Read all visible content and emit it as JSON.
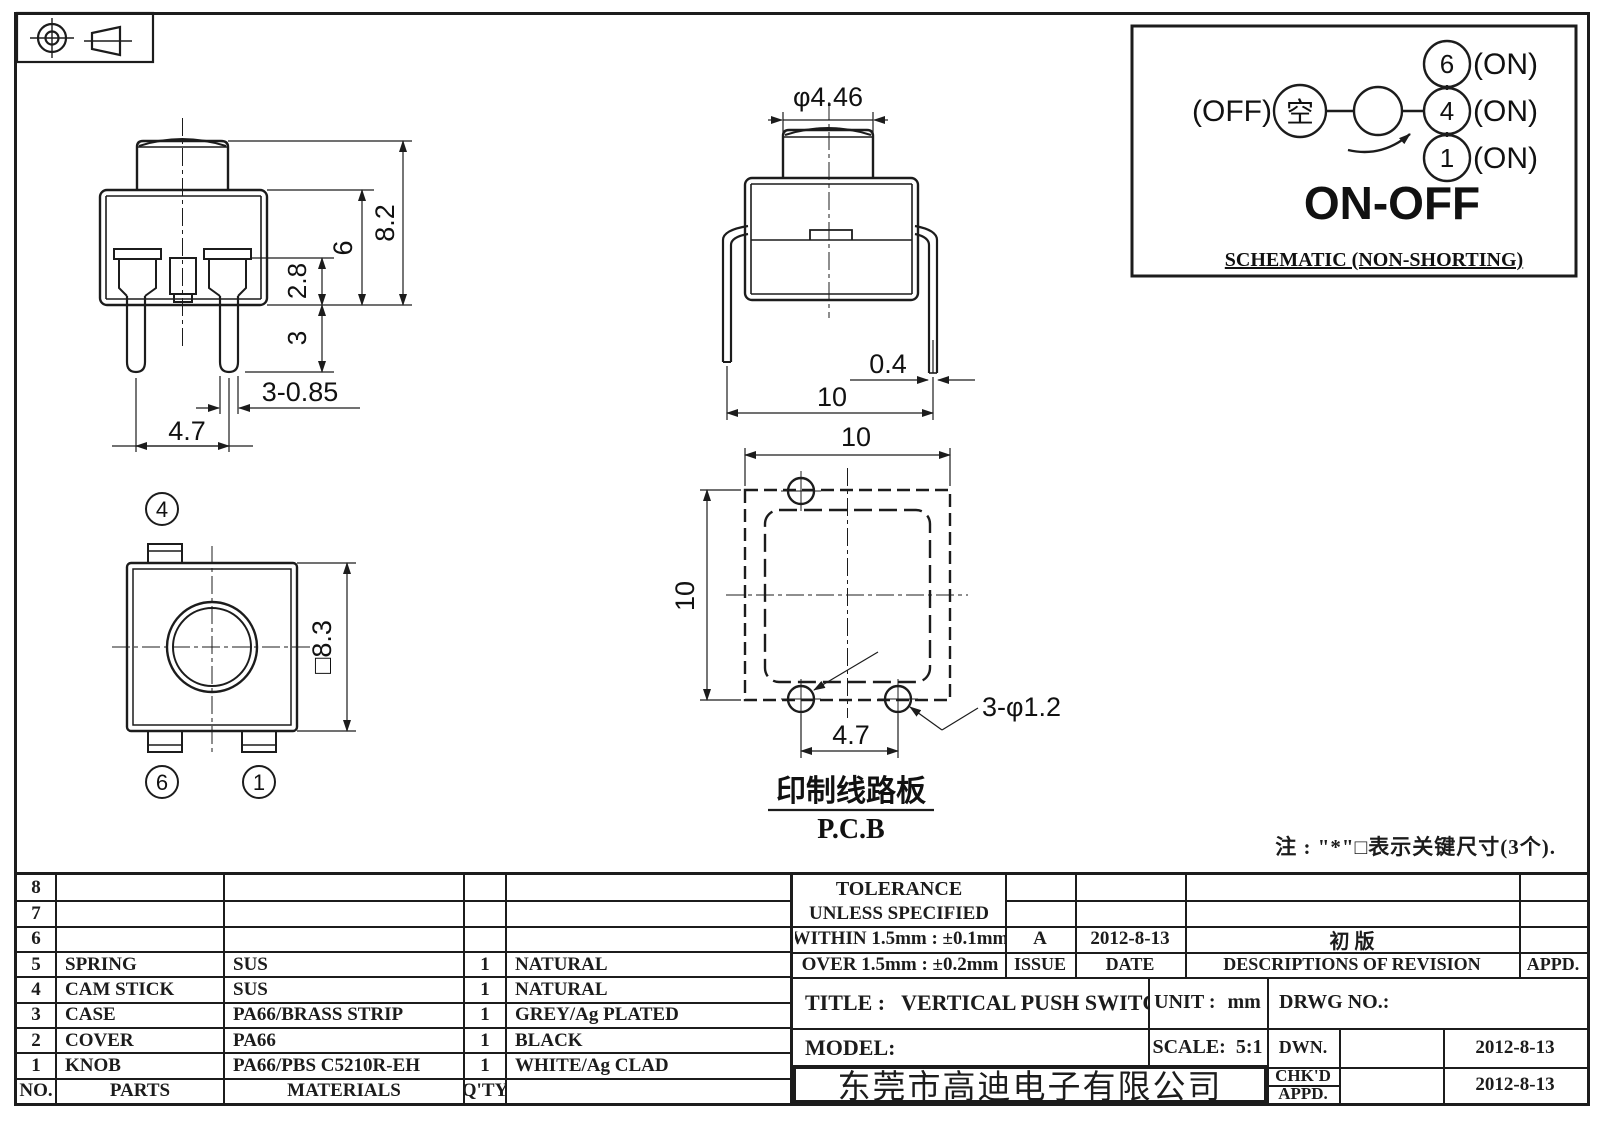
{
  "sheet": {
    "note": "注 : \"*\"□表示关键尺寸(3个)."
  },
  "views": {
    "front": {
      "dim_total_height": "8.2",
      "dim_body_height": "6",
      "dim_terminal_height": "2.8",
      "dim_leg_length": "3",
      "dim_leg_width": "3-0.85",
      "dim_leg_pitch": "4.7"
    },
    "side": {
      "dim_knob_dia": "φ4.46",
      "dim_wire_dia": "0.4",
      "dim_lead_span": "10"
    },
    "top": {
      "dim_body_size": "□8.3",
      "terminal_top": "4",
      "terminal_bottom_left": "6",
      "terminal_bottom_right": "1"
    },
    "pcb": {
      "dim_width": "10",
      "dim_height": "10",
      "dim_hole_pitch": "4.7",
      "dim_holes": "3-φ1.2",
      "label_cn": "印制线路板",
      "label_en": "P.C.B"
    }
  },
  "schematic": {
    "off_label": "(OFF)",
    "common_terminal": "空",
    "terminal_6": "6",
    "terminal_6_state": "(ON)",
    "terminal_4": "4",
    "terminal_4_state": "(ON)",
    "terminal_1": "1",
    "terminal_1_state": "(ON)",
    "function_label": "ON-OFF",
    "caption": "SCHEMATIC (NON-SHORTING)"
  },
  "parts_table": {
    "header": {
      "no": "NO.",
      "parts": "PARTS",
      "materials": "MATERIALS",
      "qty": "Q'TY",
      "finish": ""
    },
    "rows": [
      {
        "no": "8",
        "part": "",
        "material": "",
        "qty": "",
        "finish": ""
      },
      {
        "no": "7",
        "part": "",
        "material": "",
        "qty": "",
        "finish": ""
      },
      {
        "no": "6",
        "part": "",
        "material": "",
        "qty": "",
        "finish": ""
      },
      {
        "no": "5",
        "part": "SPRING",
        "material": "SUS",
        "qty": "1",
        "finish": "NATURAL"
      },
      {
        "no": "4",
        "part": "CAM STICK",
        "material": "SUS",
        "qty": "1",
        "finish": "NATURAL"
      },
      {
        "no": "3",
        "part": "CASE",
        "material": "PA66/BRASS STRIP",
        "qty": "1",
        "finish": "GREY/Ag PLATED"
      },
      {
        "no": "2",
        "part": "COVER",
        "material": "PA66",
        "qty": "1",
        "finish": "BLACK"
      },
      {
        "no": "1",
        "part": "KNOB",
        "material": "PA66/PBS C5210R-EH",
        "qty": "1",
        "finish": "WHITE/Ag CLAD"
      }
    ]
  },
  "title_block": {
    "tolerance_title": "TOLERANCE",
    "tolerance_subtitle": "UNLESS  SPECIFIED",
    "tolerance_within": "WITHIN  1.5mm : ±0.1mm",
    "tolerance_over": "OVER  1.5mm : ±0.2mm",
    "issue_value": "A",
    "issue_label": "ISSUE",
    "date_value": "2012-8-13",
    "date_label": "DATE",
    "revision_value": "初  版",
    "revision_label": "DESCRIPTIONS  OF  REVISION",
    "appd_label": "APPD.",
    "title_label": "TITLE :",
    "title_value": "VERTICAL  PUSH  SWITCH",
    "unit_label": "UNIT :",
    "unit_value": "mm",
    "drwg_label": "DRWG  NO.:",
    "model_label": "MODEL:",
    "scale_label": "SCALE:",
    "scale_value": "5:1",
    "dwn_label": "DWN.",
    "dwn_date": "2012-8-13",
    "chkd_label": "CHK'D",
    "chkd_date": "2012-8-13",
    "appd_row_label": "APPD.",
    "company": "东莞市高迪电子有限公司"
  }
}
